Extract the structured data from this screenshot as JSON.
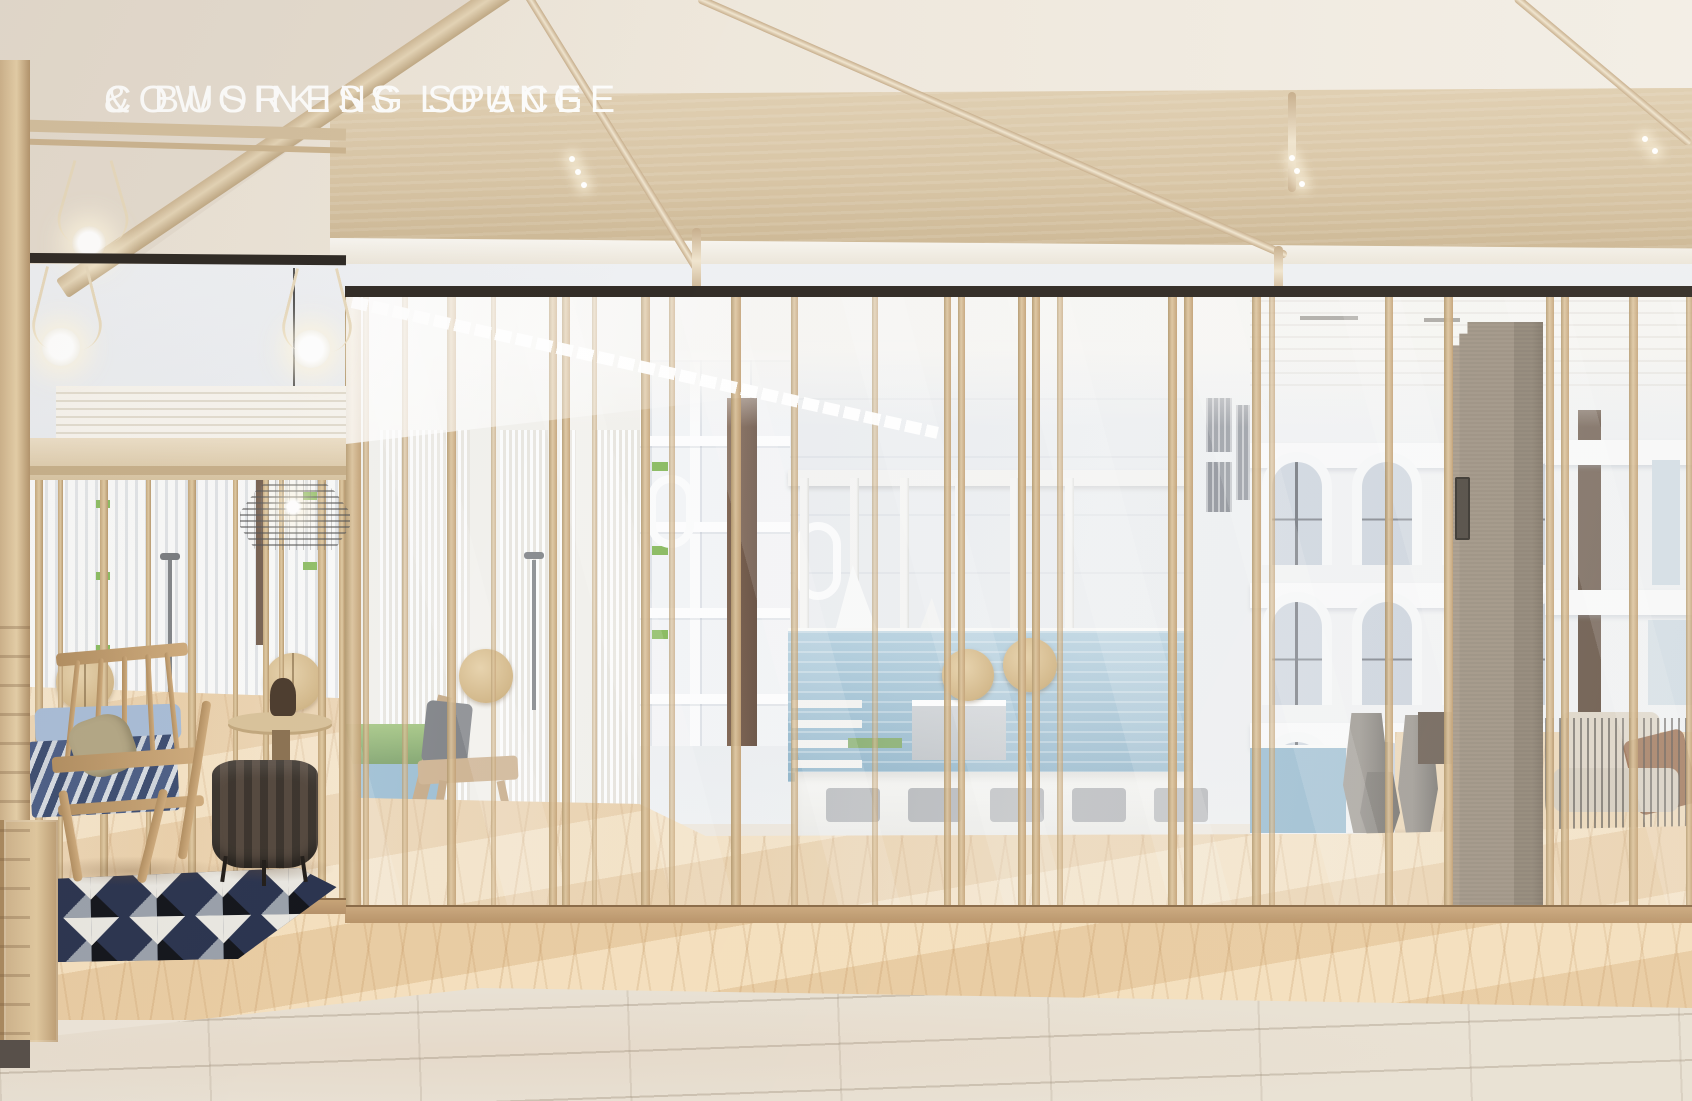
{
  "caption": {
    "line1": "COWORKING SPACE",
    "line2": "& BUSINESS LOUNGE",
    "color": "#fdfdfc"
  },
  "palette": {
    "ceiling_cream": "#ece4d8",
    "wood_fascia": "#d8c5a5",
    "wood_frame": "#caa87f",
    "wood_floor": "#ecd2ab",
    "stone_floor": "#e8e1d4",
    "track_rail": "#332d27",
    "pool_water": "#84aec8",
    "grass": "#76b043",
    "concrete_column": "#a3988a",
    "rug_navy": "#2c3550",
    "cushion_blue": "#a9bdd7",
    "pillow_khaki": "#b3a786",
    "caption_white": "#fdfdfc"
  },
  "scene": {
    "type": "architectural interior rendering",
    "objects": [
      "timber ceiling canopy with curved light conduits",
      "recessed ceiling with pendant bulb fixtures",
      "full-height glass wall with timber mullions",
      "round timber door handles",
      "wire-frame pendant lamp",
      "wooden lounge chairs with blue striped cushions",
      "khaki pillow",
      "round side table with dark vase",
      "ribbed barrel pouf",
      "geometric black and white rug",
      "herringbone parquet floor",
      "travertine stone floor",
      "concrete column with access panel",
      "gray planter vases",
      "wire-frame lounge chairs with beige cushions",
      "swimming pool courtyard",
      "white pergola with shade sails",
      "sunken lounge with gray cushions",
      "white residential buildings with arched windows",
      "building facade with vertical louvers",
      "grass mound and white fence"
    ]
  }
}
